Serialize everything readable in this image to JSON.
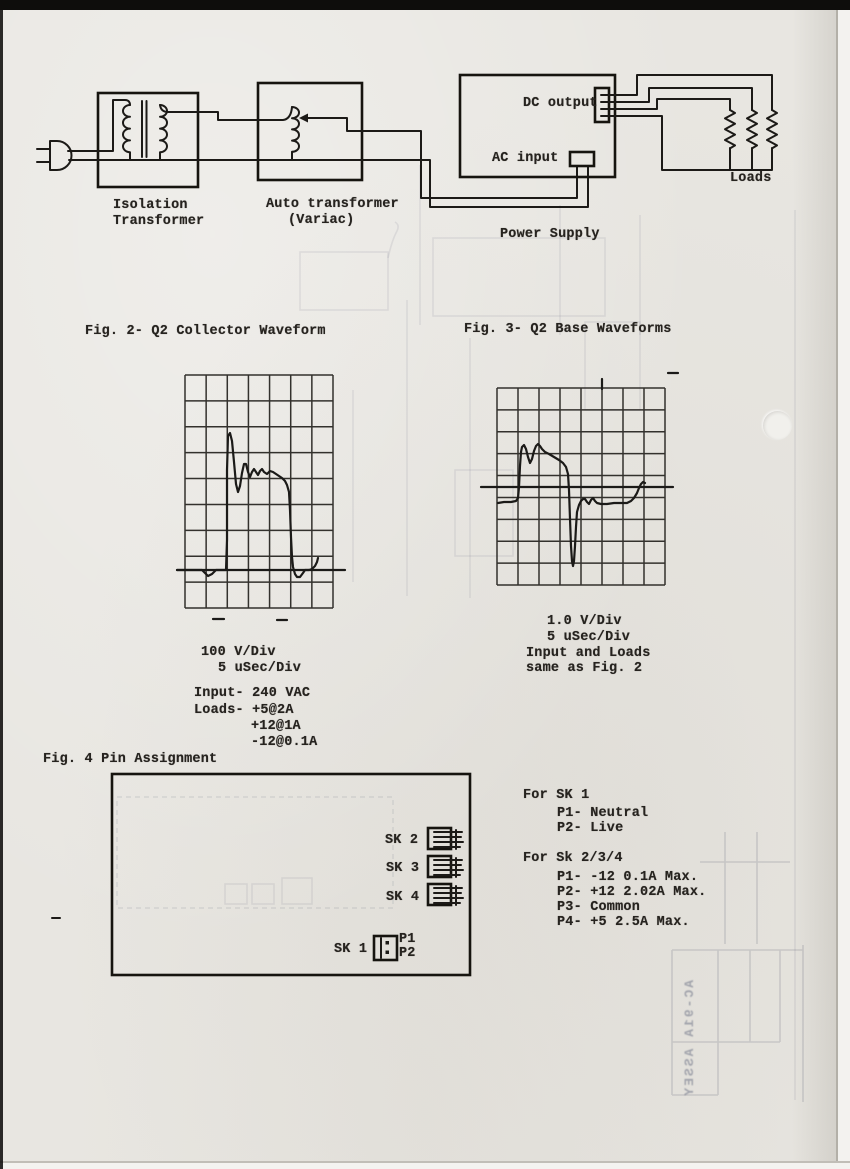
{
  "document": {
    "block_diagram": {
      "isolation_transformer": [
        "Isolation",
        "Transformer"
      ],
      "auto_transformer": [
        "Auto transformer",
        "(Variac)"
      ],
      "power_supply": "Power Supply",
      "dc_output": "DC output",
      "ac_input": "AC input",
      "loads": "Loads"
    },
    "fig2": {
      "title": "Fig. 2- Q2 Collector Waveform",
      "scale_lines": [
        "100 V/Div",
        "5 uSec/Div"
      ],
      "conditions": [
        "Input- 240 VAC",
        "Loads- +5@2A",
        "+12@1A",
        "-12@0.1A"
      ]
    },
    "fig3": {
      "title": "Fig. 3- Q2 Base Waveforms",
      "caption_lines": [
        "1.0 V/Div",
        "5 uSec/Div",
        "Input and Loads",
        "same as Fig. 2"
      ]
    },
    "fig4": {
      "title": "Fig. 4 Pin Assignment",
      "sockets": [
        "SK 2",
        "SK 3",
        "SK 4"
      ],
      "sk1": "SK 1",
      "sk1_pins": [
        "P1",
        "P2"
      ],
      "notes_sk1_header": "For SK 1",
      "notes_sk1": [
        "P1- Neutral",
        "P2- Live"
      ],
      "notes_sk234_header": "For Sk 2/3/4",
      "notes_sk234": [
        "P1- -12 0.1A Max.",
        "P2- +12 2.02A Max.",
        "P3- Common",
        "P4- +5 2.5A Max."
      ]
    },
    "ghost_bleedthrough": {
      "title_block": "AC-91A ASSEY"
    }
  },
  "chart_data": [
    {
      "type": "line",
      "title": "Fig. 2- Q2 Collector Waveform",
      "volts_per_div": 100,
      "usec_per_div": 5,
      "grid": {
        "cols": 7,
        "rows": 9
      },
      "input": "240 VAC",
      "loads": [
        "+5@2A",
        "+12@1A",
        "-12@0.1A"
      ],
      "measurements": {
        "peak_above_baseline_div": 5.3,
        "peak_volts": 530,
        "plateau_div": 3.7,
        "plateau_volts": 370,
        "pulse_width_div": 2.9,
        "pulse_width_usec": 14.5,
        "undershoot_div": 0.3
      },
      "annotations": [
        "flat baseline with small dip before pulse",
        "fast rise with ringing overshoot",
        "sloped plateau",
        "fast fall with small undershoot",
        "baseline extends beyond graticule"
      ],
      "layout": {
        "target": "scope1",
        "grid_px": {
          "x0": 185,
          "y0": 375,
          "w": 148,
          "h": 233
        },
        "axis_px": {
          "x1": 177,
          "y1": 570,
          "x2": 345,
          "y2": 570
        },
        "trace_px": [
          [
            177,
            570
          ],
          [
            196,
            570
          ],
          [
            202,
            570
          ],
          [
            204,
            572
          ],
          [
            208,
            576
          ],
          [
            212,
            574
          ],
          [
            216,
            570
          ],
          [
            226,
            570
          ],
          [
            227,
            540
          ],
          [
            227,
            470
          ],
          [
            228,
            436
          ],
          [
            230,
            433
          ],
          [
            232,
            441
          ],
          [
            234,
            462
          ],
          [
            236,
            484
          ],
          [
            238,
            492
          ],
          [
            240,
            486
          ],
          [
            242,
            473
          ],
          [
            244,
            464
          ],
          [
            246,
            464
          ],
          [
            248,
            472
          ],
          [
            250,
            477
          ],
          [
            252,
            472
          ],
          [
            254,
            469
          ],
          [
            256,
            472
          ],
          [
            258,
            475
          ],
          [
            260,
            471
          ],
          [
            262,
            469
          ],
          [
            264,
            472
          ],
          [
            267,
            474
          ],
          [
            270,
            471
          ],
          [
            273,
            472
          ],
          [
            276,
            474
          ],
          [
            279,
            476
          ],
          [
            282,
            478
          ],
          [
            285,
            481
          ],
          [
            287,
            485
          ],
          [
            289,
            492
          ],
          [
            290,
            510
          ],
          [
            291,
            537
          ],
          [
            292,
            557
          ],
          [
            293,
            567
          ],
          [
            295,
            574
          ],
          [
            297,
            577
          ],
          [
            300,
            577
          ],
          [
            303,
            573
          ],
          [
            305,
            570
          ],
          [
            309,
            570
          ],
          [
            312,
            569
          ],
          [
            315,
            566
          ],
          [
            317,
            562
          ],
          [
            318,
            558
          ]
        ],
        "marks_px": [
          [
            213,
            619,
            224,
            619
          ],
          [
            277,
            620,
            287,
            620
          ]
        ]
      }
    },
    {
      "type": "line",
      "title": "Fig. 3- Q2 Base Waveforms",
      "volts_per_div": 1.0,
      "usec_per_div": 5,
      "grid": {
        "cols": 8,
        "rows": 9
      },
      "input": "same as Fig. 2",
      "loads": "same as Fig. 2",
      "measurements": {
        "pre_pulse_level_volts": -0.7,
        "positive_peak_volts": 2.0,
        "negative_spike_volts": -3.6,
        "post_level_volts": -0.7,
        "pulse_width_usec": 11.5
      },
      "annotations": [
        "double-humped positive base drive pulse",
        "sharp negative spike at turn-off",
        "recovery to slightly negative level with small bumps",
        "trace rises back toward axis at right edge",
        "center axis line extends beyond graticule"
      ],
      "layout": {
        "target": "scope2",
        "grid_px": {
          "x0": 497,
          "y0": 388,
          "w": 168,
          "h": 197
        },
        "axis_px": {
          "x1": 481,
          "y1": 487,
          "x2": 673,
          "y2": 487
        },
        "trace_px": [
          [
            498,
            503
          ],
          [
            504,
            502
          ],
          [
            511,
            502
          ],
          [
            516,
            501
          ],
          [
            518,
            498
          ],
          [
            519,
            487
          ],
          [
            520,
            466
          ],
          [
            521,
            452
          ],
          [
            522,
            447
          ],
          [
            524,
            445
          ],
          [
            526,
            449
          ],
          [
            528,
            457
          ],
          [
            530,
            463
          ],
          [
            532,
            459
          ],
          [
            534,
            451
          ],
          [
            536,
            446
          ],
          [
            538,
            444
          ],
          [
            540,
            446
          ],
          [
            542,
            449
          ],
          [
            545,
            452
          ],
          [
            549,
            454
          ],
          [
            554,
            457
          ],
          [
            559,
            460
          ],
          [
            563,
            463
          ],
          [
            566,
            467
          ],
          [
            568,
            474
          ],
          [
            569,
            490
          ],
          [
            570,
            519
          ],
          [
            571,
            546
          ],
          [
            572,
            561
          ],
          [
            573,
            566
          ],
          [
            574,
            561
          ],
          [
            575,
            546
          ],
          [
            576,
            527
          ],
          [
            577,
            512
          ],
          [
            579,
            505
          ],
          [
            581,
            501
          ],
          [
            583,
            499
          ],
          [
            585,
            499
          ],
          [
            587,
            502
          ],
          [
            589,
            504
          ],
          [
            591,
            500
          ],
          [
            593,
            498
          ],
          [
            595,
            501
          ],
          [
            597,
            503
          ],
          [
            601,
            504
          ],
          [
            607,
            504
          ],
          [
            614,
            503
          ],
          [
            621,
            503
          ],
          [
            627,
            503
          ],
          [
            631,
            501
          ],
          [
            634,
            498
          ],
          [
            637,
            493
          ],
          [
            639,
            488
          ],
          [
            641,
            484
          ],
          [
            643,
            482
          ],
          [
            645,
            483
          ]
        ],
        "marks_px": [
          [
            668,
            373,
            678,
            373
          ],
          [
            602,
            379,
            602,
            389
          ]
        ]
      }
    }
  ]
}
